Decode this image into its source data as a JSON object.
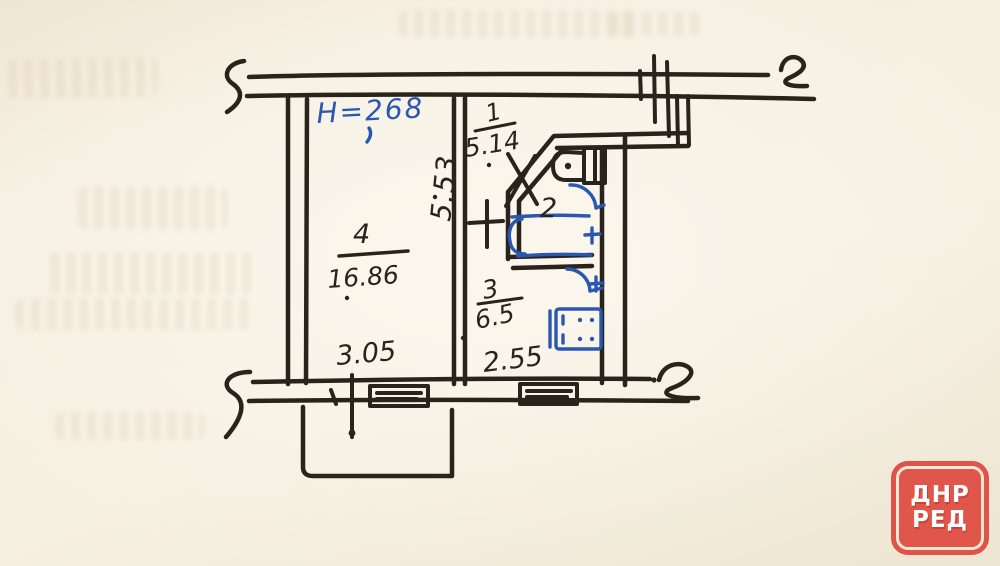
{
  "floor_plan": {
    "ceiling_height": "H=268",
    "rooms": [
      {
        "number": "1",
        "area": "5.14"
      },
      {
        "number": "2",
        "area": ""
      },
      {
        "number": "3",
        "area": "6.5"
      },
      {
        "number": "4",
        "area": "16.86"
      }
    ],
    "dimensions": {
      "depth": "5.53",
      "room4_width": "3.05",
      "kitchen_width": "2.55"
    }
  },
  "watermark": {
    "top": "ДНР",
    "bottom": "РЕД"
  },
  "colors": {
    "ink_black": "#29231b",
    "pen_blue": "#2b57b2",
    "stamp_red": "#e1564a",
    "paper": "#f4edde"
  }
}
